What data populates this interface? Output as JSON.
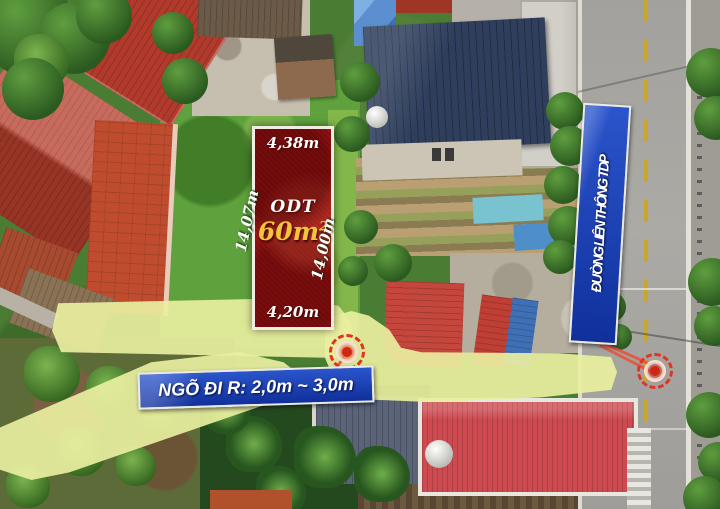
{
  "scene": {
    "description": "Aerial drone photo of a residential land plot listing in Vietnam"
  },
  "annotations": {
    "plot": {
      "land_type": "ODT",
      "area_value": "60m",
      "area_sup": "2",
      "dim_top": "4,38m",
      "dim_bottom": "4,20m",
      "dim_left": "14,07m",
      "dim_right": "14,00m"
    },
    "alley_banner": {
      "text": "NGÕ ĐI R: 2,0m ~ 3,0m"
    },
    "road_sign": {
      "text": "ĐƯỜNG LIÊN THÔNG TDP"
    },
    "markers": [
      {
        "name": "alley-entrance-marker"
      },
      {
        "name": "road-connection-marker"
      }
    ],
    "colors": {
      "plot_overlay_red": "#a21616",
      "path_highlight_yellow": "#ebefA0",
      "banner_blue": "#1d3fae",
      "marker_red": "#d93025",
      "area_text_gold": "#f2c43d"
    }
  }
}
